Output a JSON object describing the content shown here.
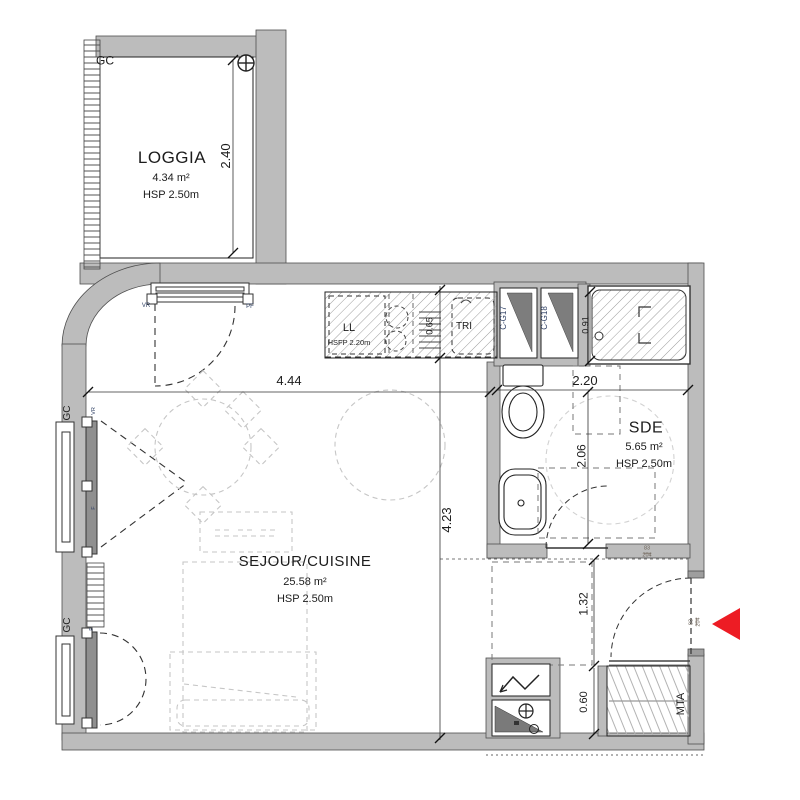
{
  "plan": {
    "rooms": {
      "loggia": {
        "name": "LOGGIA",
        "area": "4.34 m²",
        "ceiling": "HSP 2.50m"
      },
      "sejour_cuisine": {
        "name": "SEJOUR/CUISINE",
        "area": "25.58 m²",
        "ceiling": "HSP 2.50m"
      },
      "sde": {
        "name": "SDE",
        "area": "5.65 m²",
        "ceiling": "HSP 2.50m"
      }
    },
    "dimensions": {
      "loggia_depth": "2.40",
      "sejour_width": "4.44",
      "sejour_depth": "4.23",
      "counter_depth": "0.65",
      "shower_width": "0.91",
      "sde_width": "2.20",
      "sde_depth": "2.06",
      "entry_depth": "1.32",
      "closet_depth": "0.60"
    },
    "labels": {
      "gc": "GC",
      "washer": "LL",
      "washer_note": "HSFP 2.20m",
      "tri": "TRI",
      "duct_17": "C-G17",
      "duct_18": "C-G18",
      "mta": "MTA",
      "vr": "VR",
      "pf": "PF",
      "f": "F",
      "door_width": "83",
      "door_height": "204"
    },
    "colors": {
      "wall": "#bcbcbc",
      "entrance_arrow": "#ed1c24"
    }
  }
}
